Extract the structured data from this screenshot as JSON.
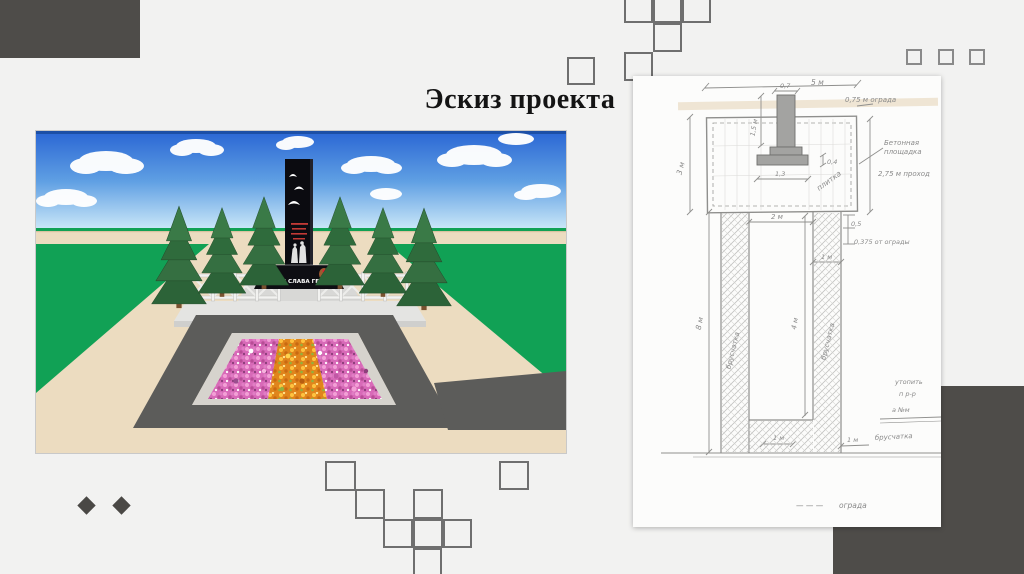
{
  "colors": {
    "background": "#f2f2f1",
    "dark_block": "#4e4c49",
    "pencil": "#8a8a8a",
    "sky_top": "#2a66d4",
    "grass": "#11a155",
    "road": "#5c5c5a",
    "plaza": "#ecdcc0"
  },
  "slide": {
    "title": "Эскиз проекта"
  },
  "render": {
    "base_caption": "ВЕЧНАЯ СЛАВА ГЕРОЯМ"
  },
  "sketch": {
    "dim_top_width": "5 м",
    "dim_col_width": "0,7",
    "dim_col_height": "1,5 м",
    "dim_base_width": "1,3",
    "dim_base_height": "0,4",
    "dim_left_height": "3 м",
    "fence_offset": "0,75 м ограда",
    "platform_label_1": "Бетонная",
    "platform_label_2": "площадка",
    "passage": "2,75 м проход",
    "tile": "плитка",
    "dim_walk_width": "2 м",
    "dim_gap": "0,5",
    "fence_gap": "0,375 от ограды",
    "dim_path_right": "1 м",
    "dim_path_bottom_left": "1 м",
    "dim_path_bottom_right": "1 м",
    "dim_inner_height": "4 м",
    "dim_total_height": "8 м",
    "paving_left": "брусчатка",
    "paving_right": "брусчатка",
    "paving_bottom": "брусчатка",
    "note_1": "утопить",
    "note_2": "п  р-р",
    "note_3": "а №м",
    "legend_dashes": "— — —",
    "legend_label": "ограда"
  }
}
